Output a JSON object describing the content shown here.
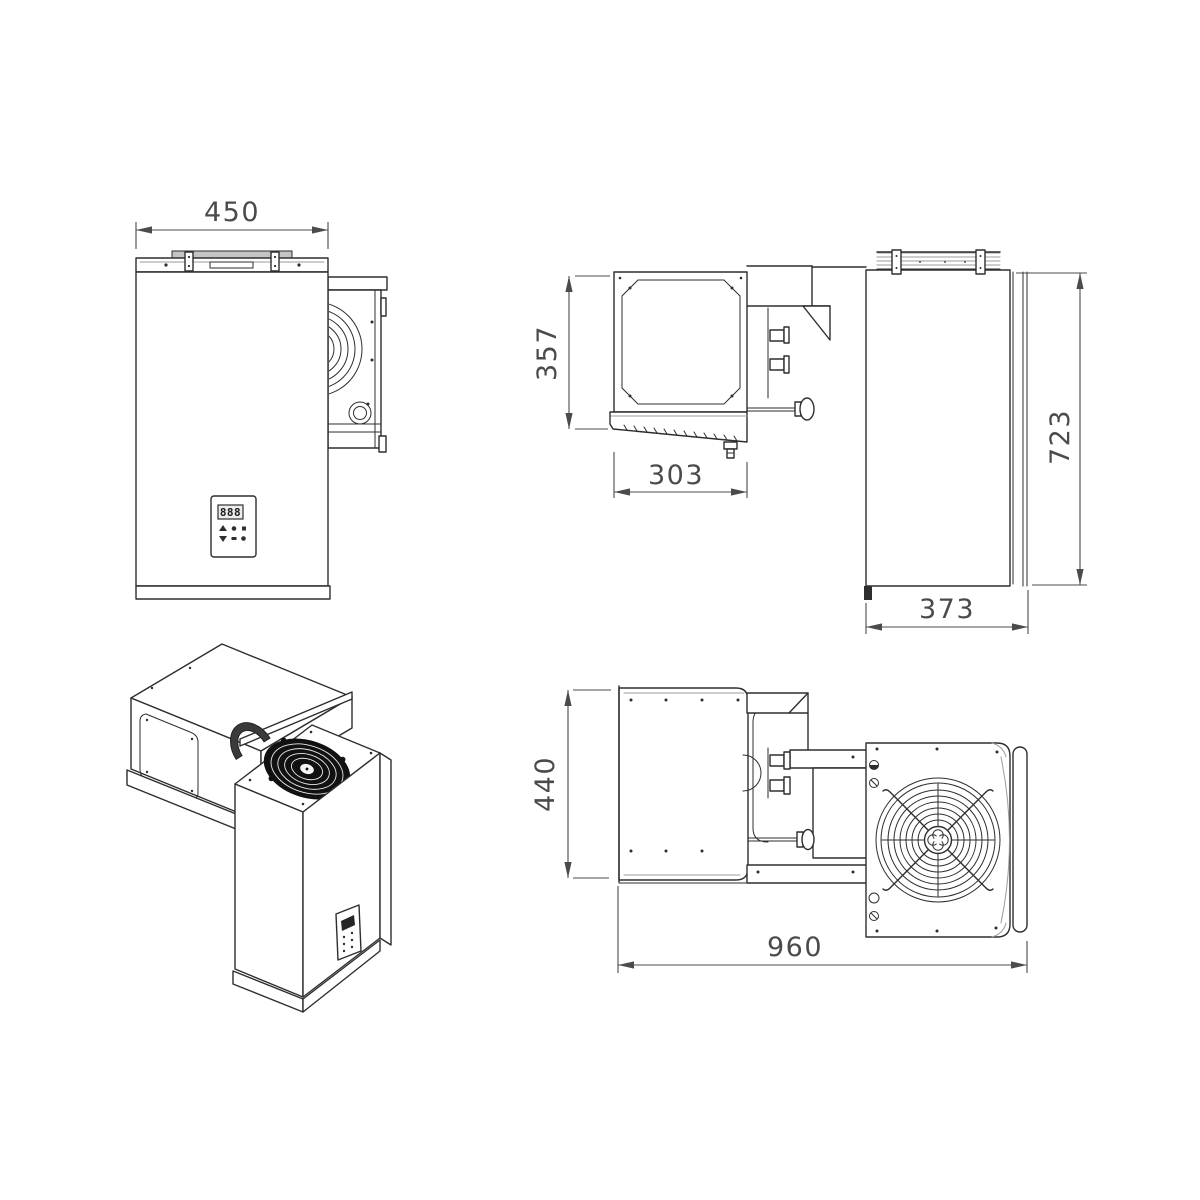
{
  "drawing": {
    "type": "technical-orthographic-drawing",
    "subject": "cold-room monoblock refrigeration unit",
    "colors": {
      "line": "#2e2e2e",
      "dimension": "#4b4b4b",
      "detail_gray": "#9b9b9b",
      "rail_fill": "#c4c4c4",
      "fan": "#111111"
    },
    "views": {
      "front": {
        "dim_width": "450",
        "display_value": "888"
      },
      "side": {
        "dim_evaporator_height": "357",
        "dim_evaporator_depth": "303",
        "dim_overall_height": "723",
        "dim_condenser_depth": "373"
      },
      "top": {
        "dim_depth": "440",
        "dim_overall_length": "960"
      }
    }
  }
}
